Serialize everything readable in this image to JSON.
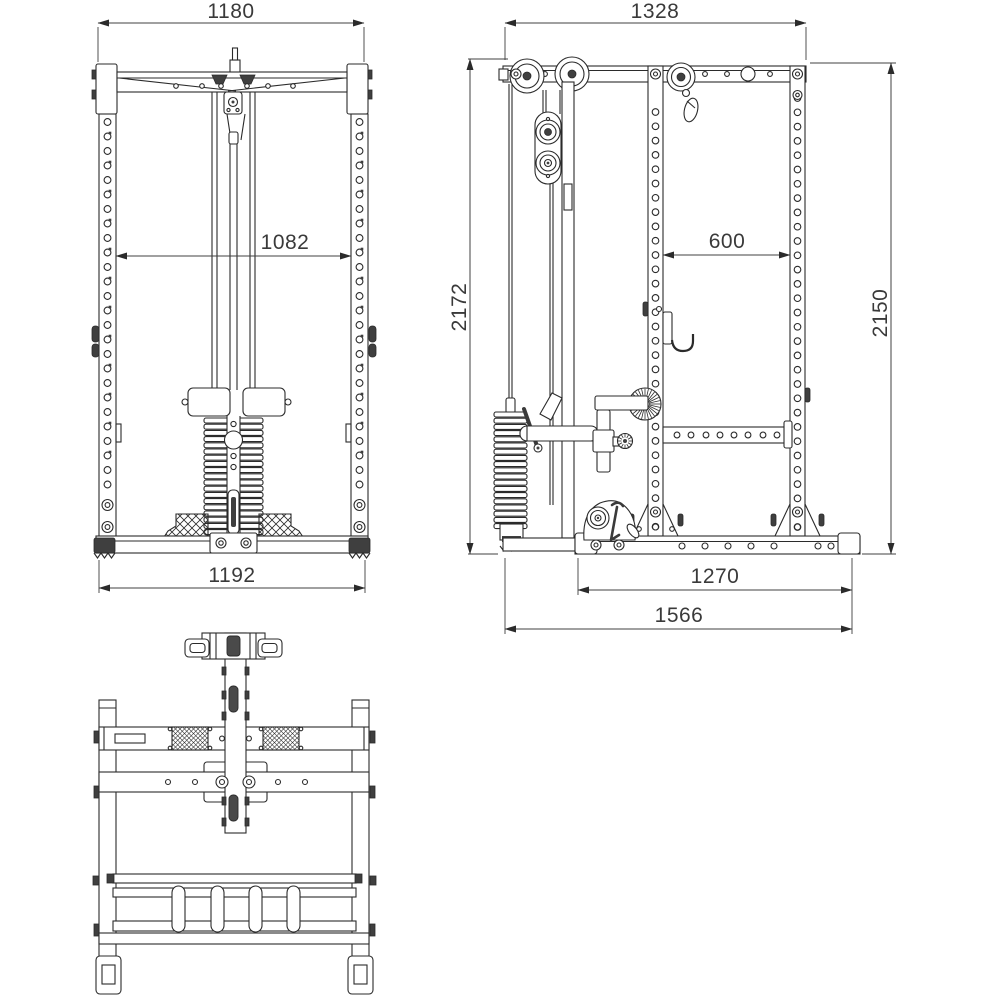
{
  "drawing": {
    "background": "#ffffff",
    "line_color": "#2b2b2b",
    "text_color": "#3a3a3a",
    "views": {
      "front": {
        "label": "front-view",
        "dimensions": {
          "top_width": "1180",
          "inner_width": "1082",
          "base_width": "1192"
        }
      },
      "side": {
        "label": "side-view",
        "dimensions": {
          "top_width": "1328",
          "post_spacing": "600",
          "overall_height": "2172",
          "frame_height": "2150",
          "base_length": "1270",
          "overall_depth": "1566"
        }
      },
      "plan": {
        "label": "plan-view",
        "dimensions": {}
      }
    }
  }
}
